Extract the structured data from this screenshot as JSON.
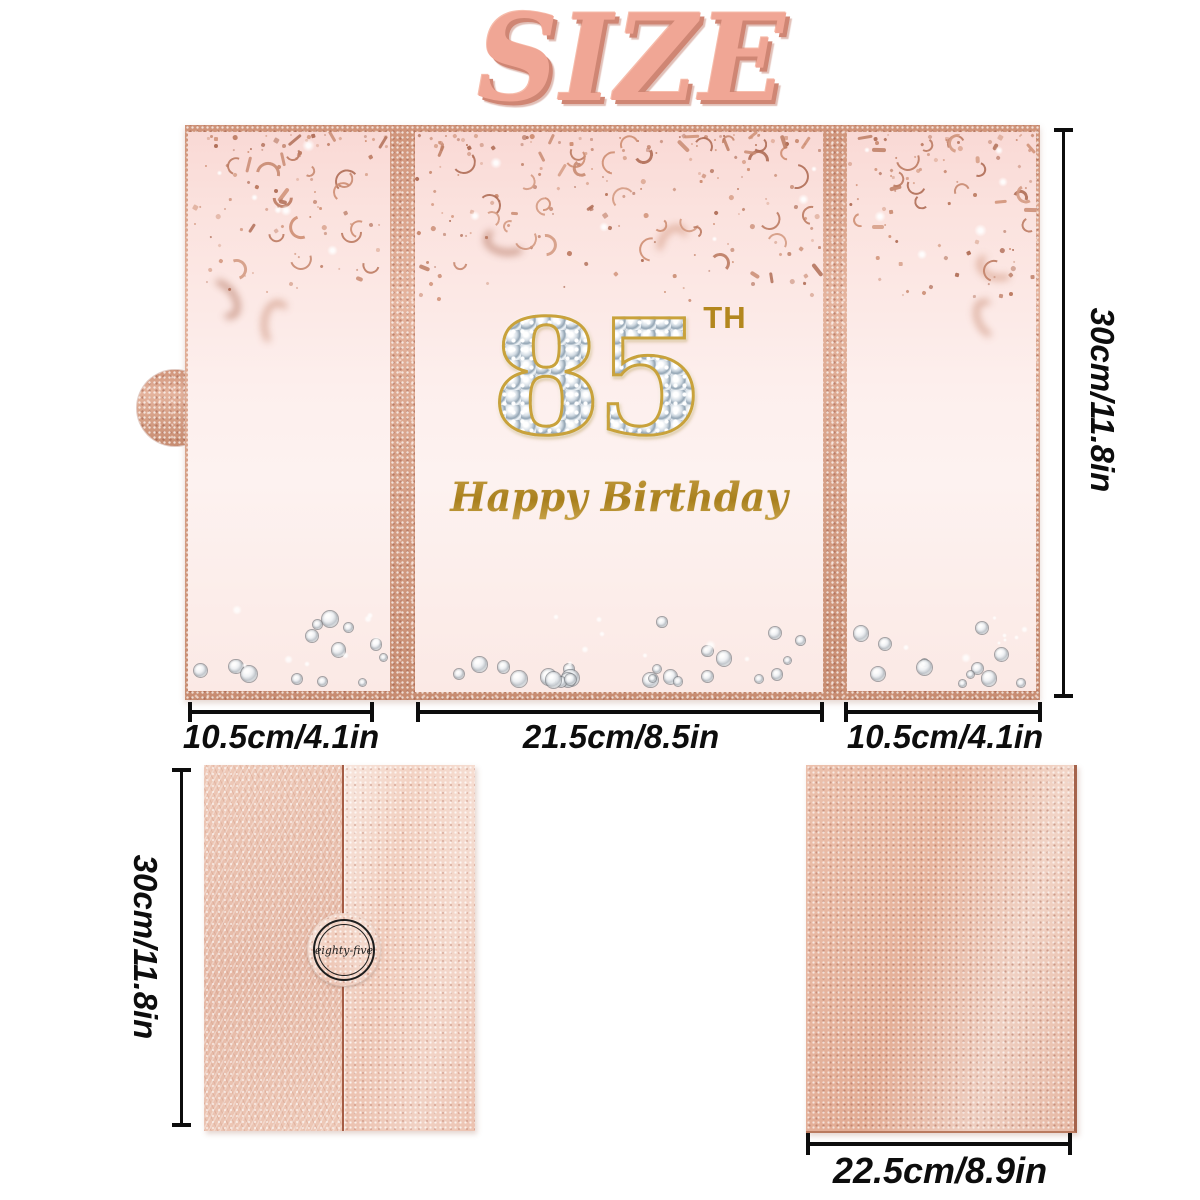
{
  "title": "SIZE",
  "open_card": {
    "number": "85",
    "suffix": "TH",
    "greeting": "Happy Birthday",
    "height_label": "30cm/11.8in",
    "left_width_label": "10.5cm/4.1in",
    "center_width_label": "21.5cm/8.5in",
    "right_width_label": "10.5cm/4.1in"
  },
  "closed_card_front": {
    "seal_label": "eighty-five",
    "height_label": "30cm/11.8in"
  },
  "closed_card_back": {
    "width_label": "22.5cm/8.9in"
  },
  "colors": {
    "title_salmon": "#f0a695",
    "rose_gold": "#d9a48c",
    "blush_pink": "#fdefed",
    "gold": "#b3871e",
    "dimension_black": "#0d0d0d"
  }
}
